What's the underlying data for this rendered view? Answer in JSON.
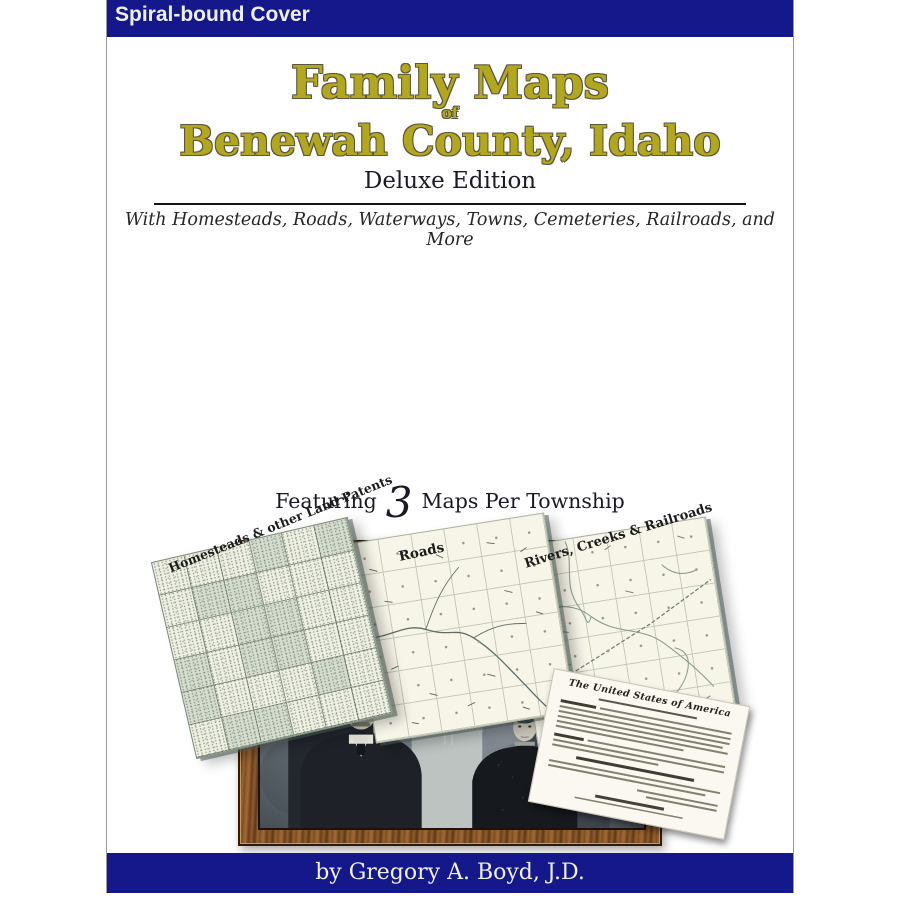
{
  "banner": {
    "label": "Spiral-bound Cover"
  },
  "title": {
    "line1": "Family Maps",
    "connector": "of",
    "line2": "Benewah County, Idaho",
    "edition": "Deluxe Edition"
  },
  "subtitle": "With Homesteads, Roads, Waterways, Towns, Cemeteries, Railroads, and More",
  "maps": {
    "homesteads_label": "Homesteads & other Land Patents",
    "roads_label": "Roads",
    "rivers_label": "Rivers, Creeks & Railroads"
  },
  "featuring": {
    "prefix": "Featuring",
    "count": "3",
    "suffix": "Maps Per Township"
  },
  "patent_document": {
    "heading": "The United States of America"
  },
  "author_bar": {
    "text": "by Gregory A. Boyd, J.D."
  },
  "colors": {
    "navy": "#15188a",
    "title_olive": "#b3a71e",
    "map_sage": "#d5ddcf",
    "map_cream": "#f7f5e8",
    "frame_wood": "#7c4e24"
  }
}
